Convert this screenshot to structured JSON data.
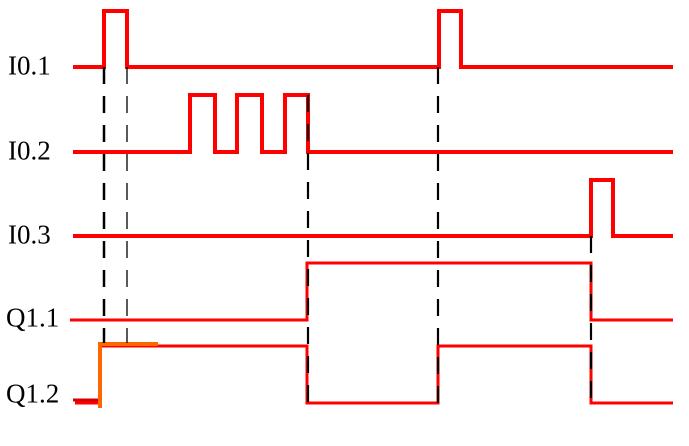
{
  "title": "PLC timing diagram",
  "colors": {
    "trace_red": "#ff0000",
    "highlight_orange": "#ff6600",
    "start_dark_red": "#d40000",
    "marker_black": "#000000",
    "label_black": "#000000",
    "background": "#ffffff"
  },
  "chart_data": {
    "type": "timing-diagram",
    "x_range": [
      73,
      673
    ],
    "dash_pattern": "17,12",
    "signals": [
      {
        "label": "I0.1",
        "kind": "input",
        "base_y": 67,
        "high_y": 11,
        "label_x": 8,
        "label_y": 66,
        "stroke_width": 4,
        "high_intervals_x": [
          [
            104,
            127
          ],
          [
            439,
            461
          ]
        ],
        "points": [
          [
            73,
            67
          ],
          [
            104,
            67
          ],
          [
            104,
            11
          ],
          [
            127,
            11
          ],
          [
            127,
            67
          ],
          [
            439,
            67
          ],
          [
            439,
            11
          ],
          [
            461,
            11
          ],
          [
            461,
            67
          ],
          [
            673,
            67
          ]
        ]
      },
      {
        "label": "I0.2",
        "kind": "input",
        "base_y": 152,
        "high_y": 95,
        "label_x": 8,
        "label_y": 151,
        "stroke_width": 4,
        "high_intervals_x": [
          [
            190,
            215
          ],
          [
            237,
            262
          ],
          [
            285,
            308
          ]
        ],
        "points": [
          [
            73,
            152
          ],
          [
            190,
            152
          ],
          [
            190,
            95
          ],
          [
            215,
            95
          ],
          [
            215,
            152
          ],
          [
            237,
            152
          ],
          [
            237,
            95
          ],
          [
            262,
            95
          ],
          [
            262,
            152
          ],
          [
            285,
            152
          ],
          [
            285,
            95
          ],
          [
            308,
            95
          ],
          [
            308,
            152
          ],
          [
            673,
            152
          ]
        ]
      },
      {
        "label": "I0.3",
        "kind": "input",
        "base_y": 236,
        "high_y": 180,
        "label_x": 8,
        "label_y": 235,
        "stroke_width": 4,
        "high_intervals_x": [
          [
            591,
            613
          ]
        ],
        "points": [
          [
            73,
            236
          ],
          [
            591,
            236
          ],
          [
            591,
            180
          ],
          [
            613,
            180
          ],
          [
            613,
            236
          ],
          [
            673,
            236
          ]
        ]
      },
      {
        "label": "Q1.1",
        "kind": "output",
        "base_y": 320,
        "high_y": 263,
        "label_x": 6,
        "label_y": 318,
        "stroke_width": 3,
        "high_intervals_x": [
          [
            307,
            591
          ]
        ],
        "points": [
          [
            70,
            320
          ],
          [
            307,
            320
          ],
          [
            307,
            263
          ],
          [
            591,
            263
          ],
          [
            591,
            320
          ],
          [
            673,
            320
          ]
        ]
      },
      {
        "label": "Q1.2",
        "kind": "output",
        "base_y": 403,
        "high_y": 346,
        "label_x": 6,
        "label_y": 394,
        "stroke_width": 3,
        "high_intervals_x": [
          [
            100,
            307
          ],
          [
            438,
            591
          ]
        ],
        "points": [
          [
            75,
            403
          ],
          [
            100,
            403
          ],
          [
            100,
            346
          ],
          [
            307,
            346
          ],
          [
            307,
            403
          ],
          [
            438,
            403
          ],
          [
            438,
            346
          ],
          [
            591,
            346
          ],
          [
            591,
            403
          ],
          [
            673,
            403
          ]
        ]
      }
    ],
    "overlays": [
      {
        "name": "q12-start-segment",
        "color_key": "start_dark_red",
        "stroke_width": 3,
        "points": [
          [
            73,
            400
          ],
          [
            101,
            400
          ]
        ]
      },
      {
        "name": "q12-set-highlight",
        "color_key": "highlight_orange",
        "stroke_width": 4,
        "points": [
          [
            100,
            408
          ],
          [
            100,
            344
          ],
          [
            158,
            344
          ]
        ]
      }
    ],
    "dashed_markers": [
      {
        "x": 104,
        "y1": 67,
        "y2": 343,
        "stroke_width": 2.5
      },
      {
        "x": 127,
        "y1": 67,
        "y2": 343,
        "stroke_width": 1.3
      },
      {
        "x": 308,
        "y1": 95,
        "y2": 404,
        "stroke_width": 2.2
      },
      {
        "x": 438,
        "y1": 67,
        "y2": 404,
        "stroke_width": 2.2
      },
      {
        "x": 591,
        "y1": 236,
        "y2": 404,
        "stroke_width": 2.2
      }
    ]
  }
}
